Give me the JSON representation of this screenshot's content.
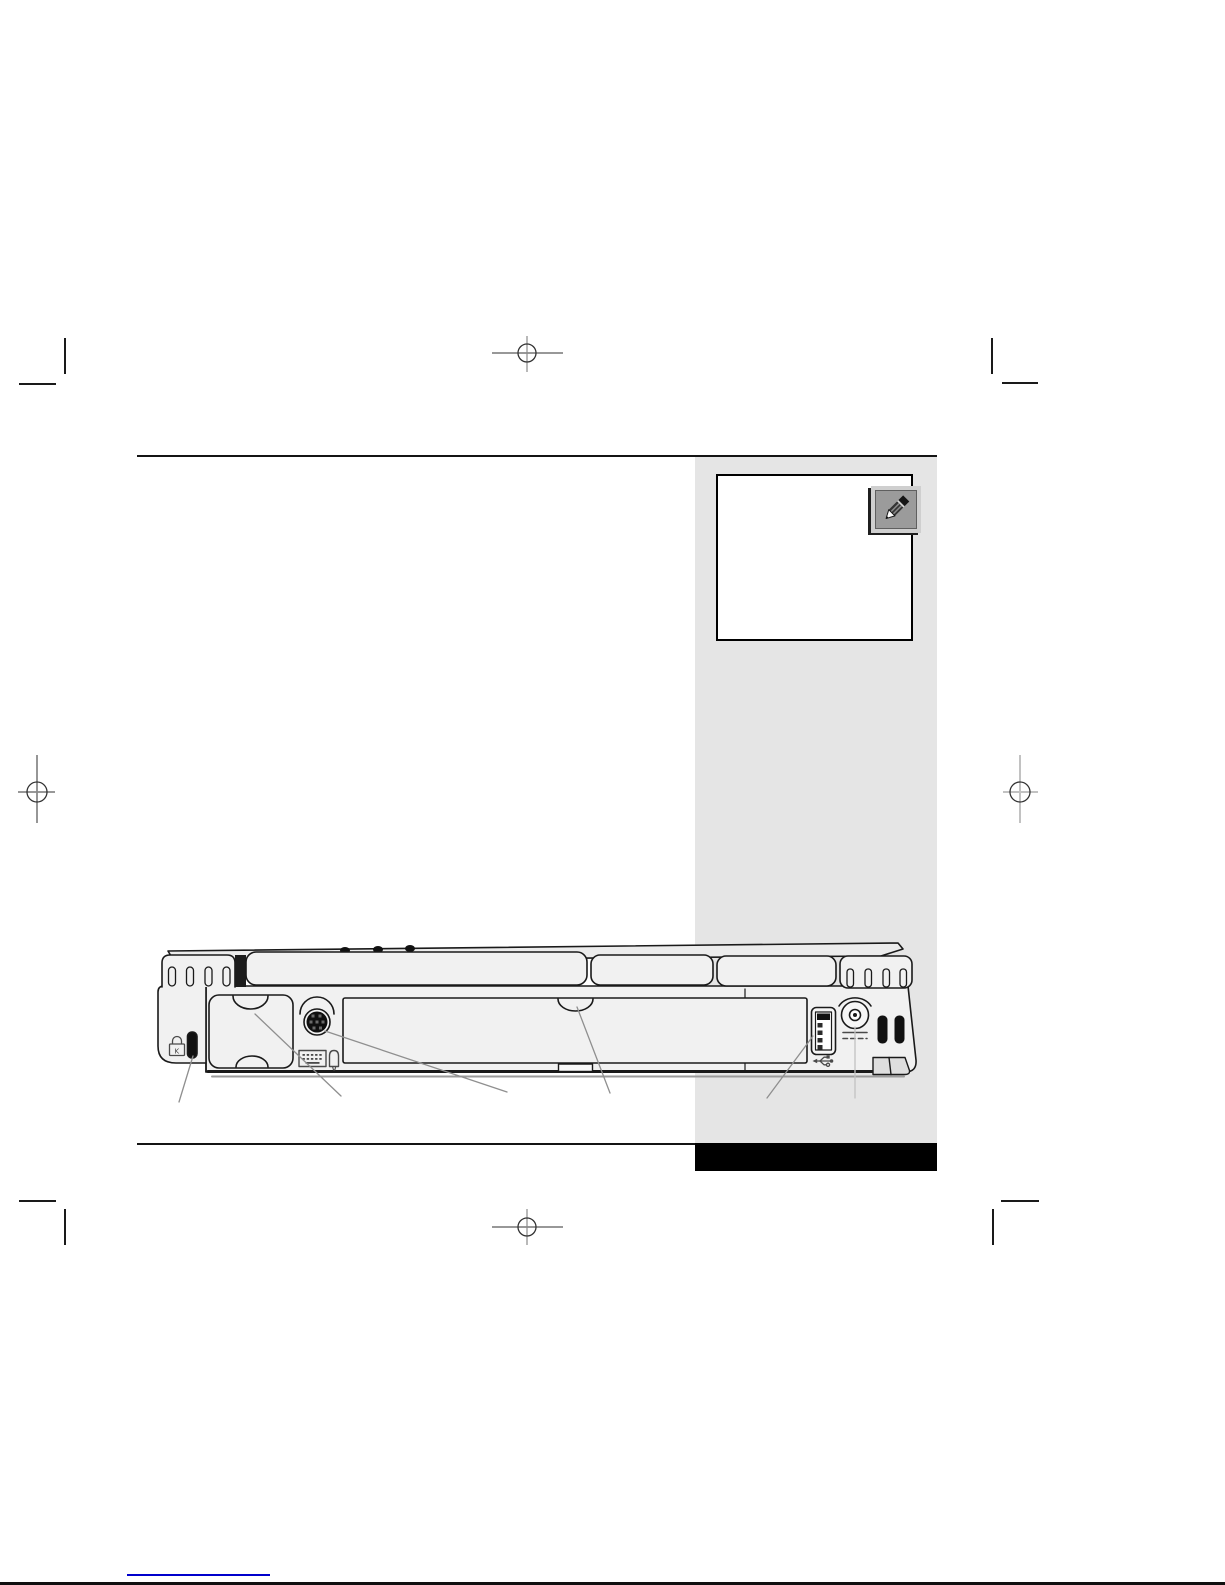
{
  "page": {
    "width": 1225,
    "height": 1585,
    "description": "printed manual page proof with crop marks showing notebook rear view diagram"
  },
  "theme": {
    "page_background": "#ffffff",
    "rule_color": "#141414",
    "sidebar_color": "#e5e5e5",
    "footer_bar_color": "#000000",
    "note_background": "#ffffff",
    "note_border_color": "#000000",
    "icon_frame_color": "#cfcfcf",
    "icon_panel_color": "#9b9b9b",
    "outline_color": "#1a1a1a",
    "body_fill": "#f1f1f1",
    "leader_color": "#8f8f8f",
    "leader_light_color": "#c2c2c2",
    "mark_color": "#1a1a1a",
    "mark_cross_color": "#8a8a8a",
    "link_underline_color": "#0000cc"
  },
  "sidebar": {
    "note_box": {
      "icon": "pencil-icon"
    }
  },
  "diagram": {
    "title": "notebook-rear-view",
    "kensington_letter": "K",
    "ports": [
      {
        "name": "kensington-lock-slot"
      },
      {
        "name": "left-port-cover"
      },
      {
        "name": "ps2-keyboard-mouse-port"
      },
      {
        "name": "center-expansion-cover"
      },
      {
        "name": "usb-port"
      },
      {
        "name": "dc-power-jack"
      }
    ],
    "icons": [
      "kensington-lock-icon",
      "ps2-keyboard-icon",
      "ps2-mouse-icon",
      "usb-icon",
      "dc-power-icon"
    ],
    "leader_line_count": 6
  },
  "print_marks": {
    "corner_marks": 4,
    "registration_targets": 4
  },
  "footer": {
    "has_link_underline": true
  }
}
